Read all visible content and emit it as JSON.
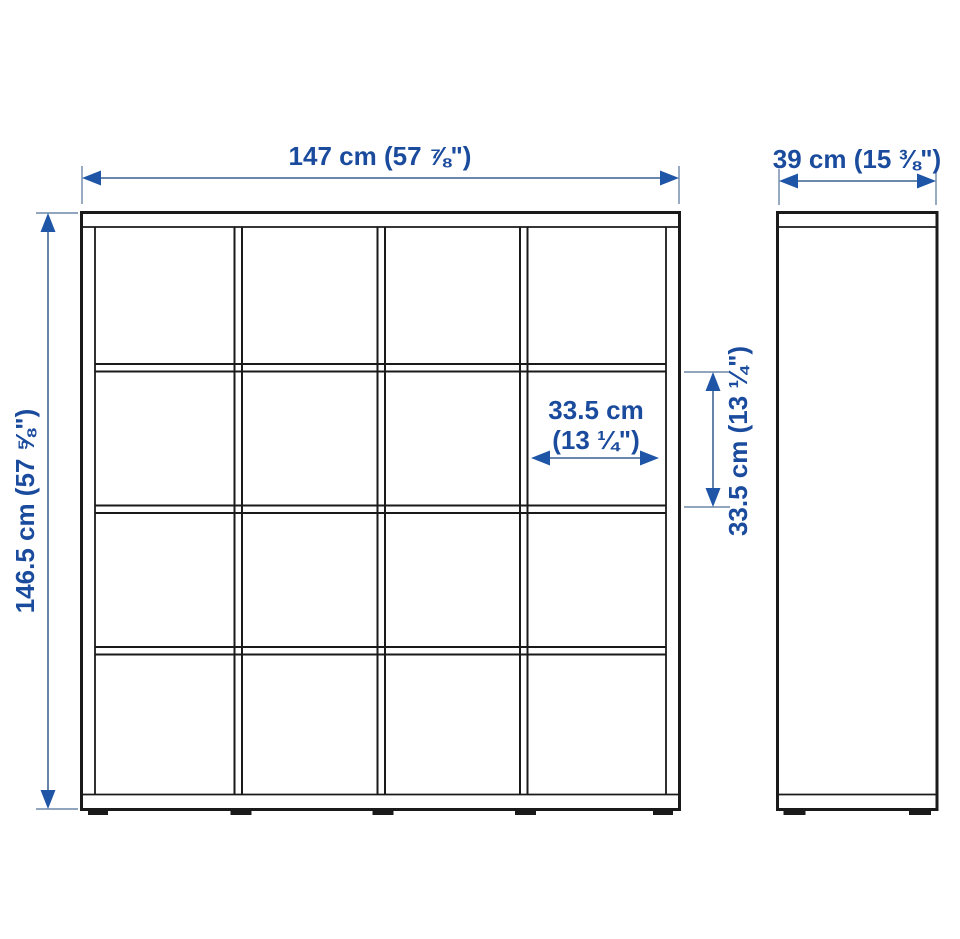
{
  "colors": {
    "outline_black": "#1a1a1a",
    "dimension_line_blue": "#54779f",
    "arrowhead_blue": "#1f55a6",
    "label_text_blue": "#1a4b9d",
    "background": "#ffffff"
  },
  "front_view": {
    "width_label": "147 cm (57 ⅞\")",
    "height_label": "146.5 cm (57 ⅝\")",
    "grid": {
      "rows": 4,
      "columns": 4,
      "compartments": 16
    },
    "cell": {
      "width_label_line1": "33.5 cm",
      "width_label_line2": "(13 ¼\")",
      "height_label": "33.5 cm (13 ¼\")"
    }
  },
  "side_view": {
    "depth_label": "39 cm (15 ⅜\")"
  }
}
